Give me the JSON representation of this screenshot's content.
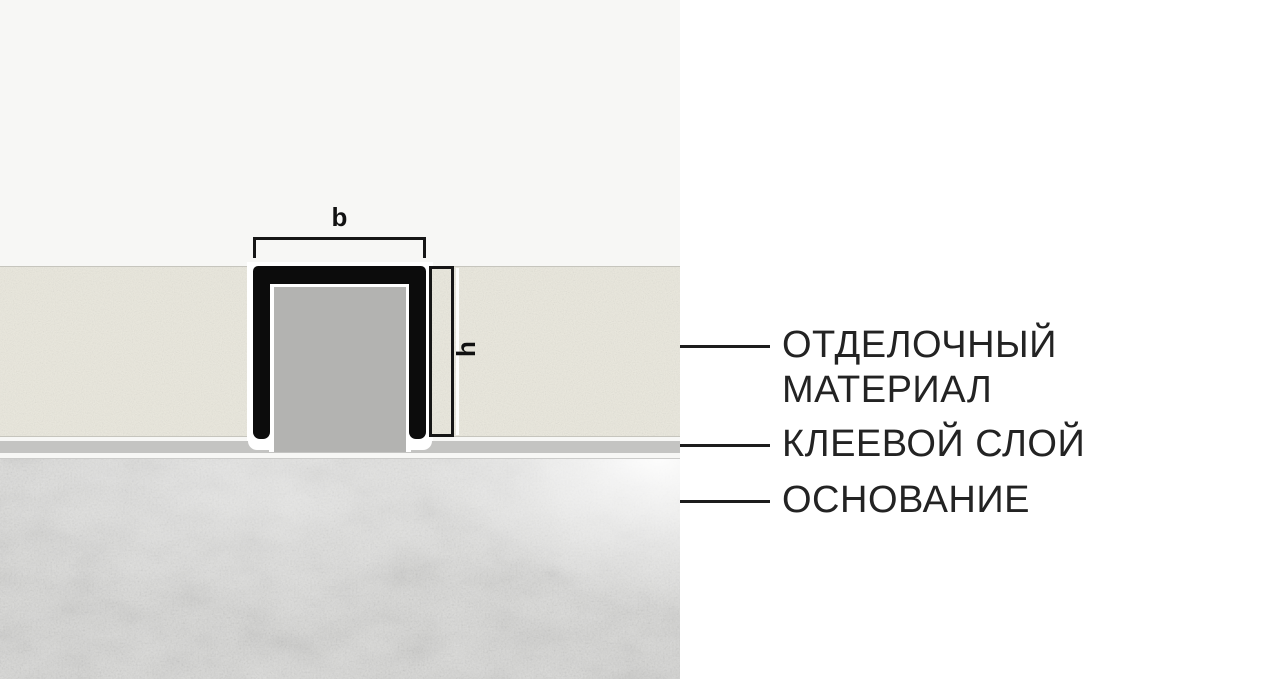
{
  "diagram": {
    "title": "expansion-joint-profile-cross-section",
    "dimension_width_label": "b",
    "dimension_height_label": "h"
  },
  "legend": {
    "finishing": {
      "line1": "ОТДЕЛОЧНЫЙ",
      "line2": "МАТЕРИАЛ"
    },
    "adhesive": {
      "label": "КЛЕЕВОЙ СЛОЙ"
    },
    "base": {
      "label": "ОСНОВАНИЕ"
    }
  },
  "colors": {
    "background_left": "#f7f7f5",
    "background_right": "#ffffff",
    "tile": "#eae8dd",
    "tile_border": "#c6c5bd",
    "profile_black": "#0c0c0c",
    "profile_filler_gray": "#b3b3b1",
    "adhesive_gray": "#c4c4c2",
    "base_concrete": "#d9d9d7",
    "text": "#232323",
    "callout_line": "#1c1c1c"
  }
}
